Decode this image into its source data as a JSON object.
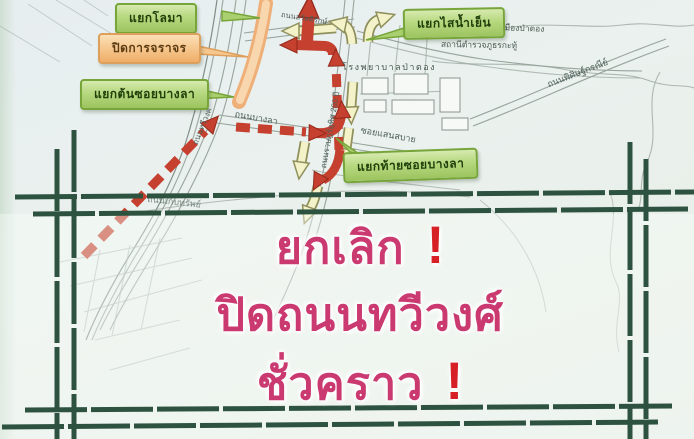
{
  "callouts": {
    "dolphin": {
      "label": "แยกโลมา"
    },
    "closed": {
      "label": "ปิดการจราจร"
    },
    "bangla_start": {
      "label": "แยกต้นซอยบางลา"
    },
    "sainamyen": {
      "label": "แยกไสน้ำเย็น"
    },
    "bangla_end": {
      "label": "แยกท้ายซอยบางลา"
    }
  },
  "streets": {
    "sawatdirak": "ถนนสวัสดิรักษ์",
    "bangla": "ถนนบางลา",
    "ratuthit": "ถนนราษฎร์อุทิศ 200 ปี",
    "thawewong": "ถนนทวีวงศ์",
    "sansabai": "ซอยแสนสบาย",
    "phisit": "ถนนพิศิษฐ์กรณีย์",
    "kebsub": "ถนนเก็บทรัพย์"
  },
  "places": {
    "hospital": "โรงพยาบาลป่าตอง",
    "municipality": "สำนักงานเทศบาลเมืองป่าตอง",
    "police": "สถานีตำรวจภูธรกะทู้"
  },
  "overlay": {
    "line1": "ยกเลิก",
    "line2": "ปิดถนนทวีวงศ์",
    "line3": "ชั่วคราว",
    "exclaim": "!"
  },
  "colors": {
    "label_green": "#a9cf6e",
    "label_green_border": "#77a53a",
    "label_orange": "#f6c78e",
    "label_orange_border": "#dd9f5c",
    "frame_green": "#2d5340",
    "announce_pink": "#ca3a70",
    "exclaim_red": "#d71f26",
    "arrow_red": "#c5402f",
    "arrow_yellow": "#f4f2c9",
    "road_closed_orange": "#eeb078"
  }
}
